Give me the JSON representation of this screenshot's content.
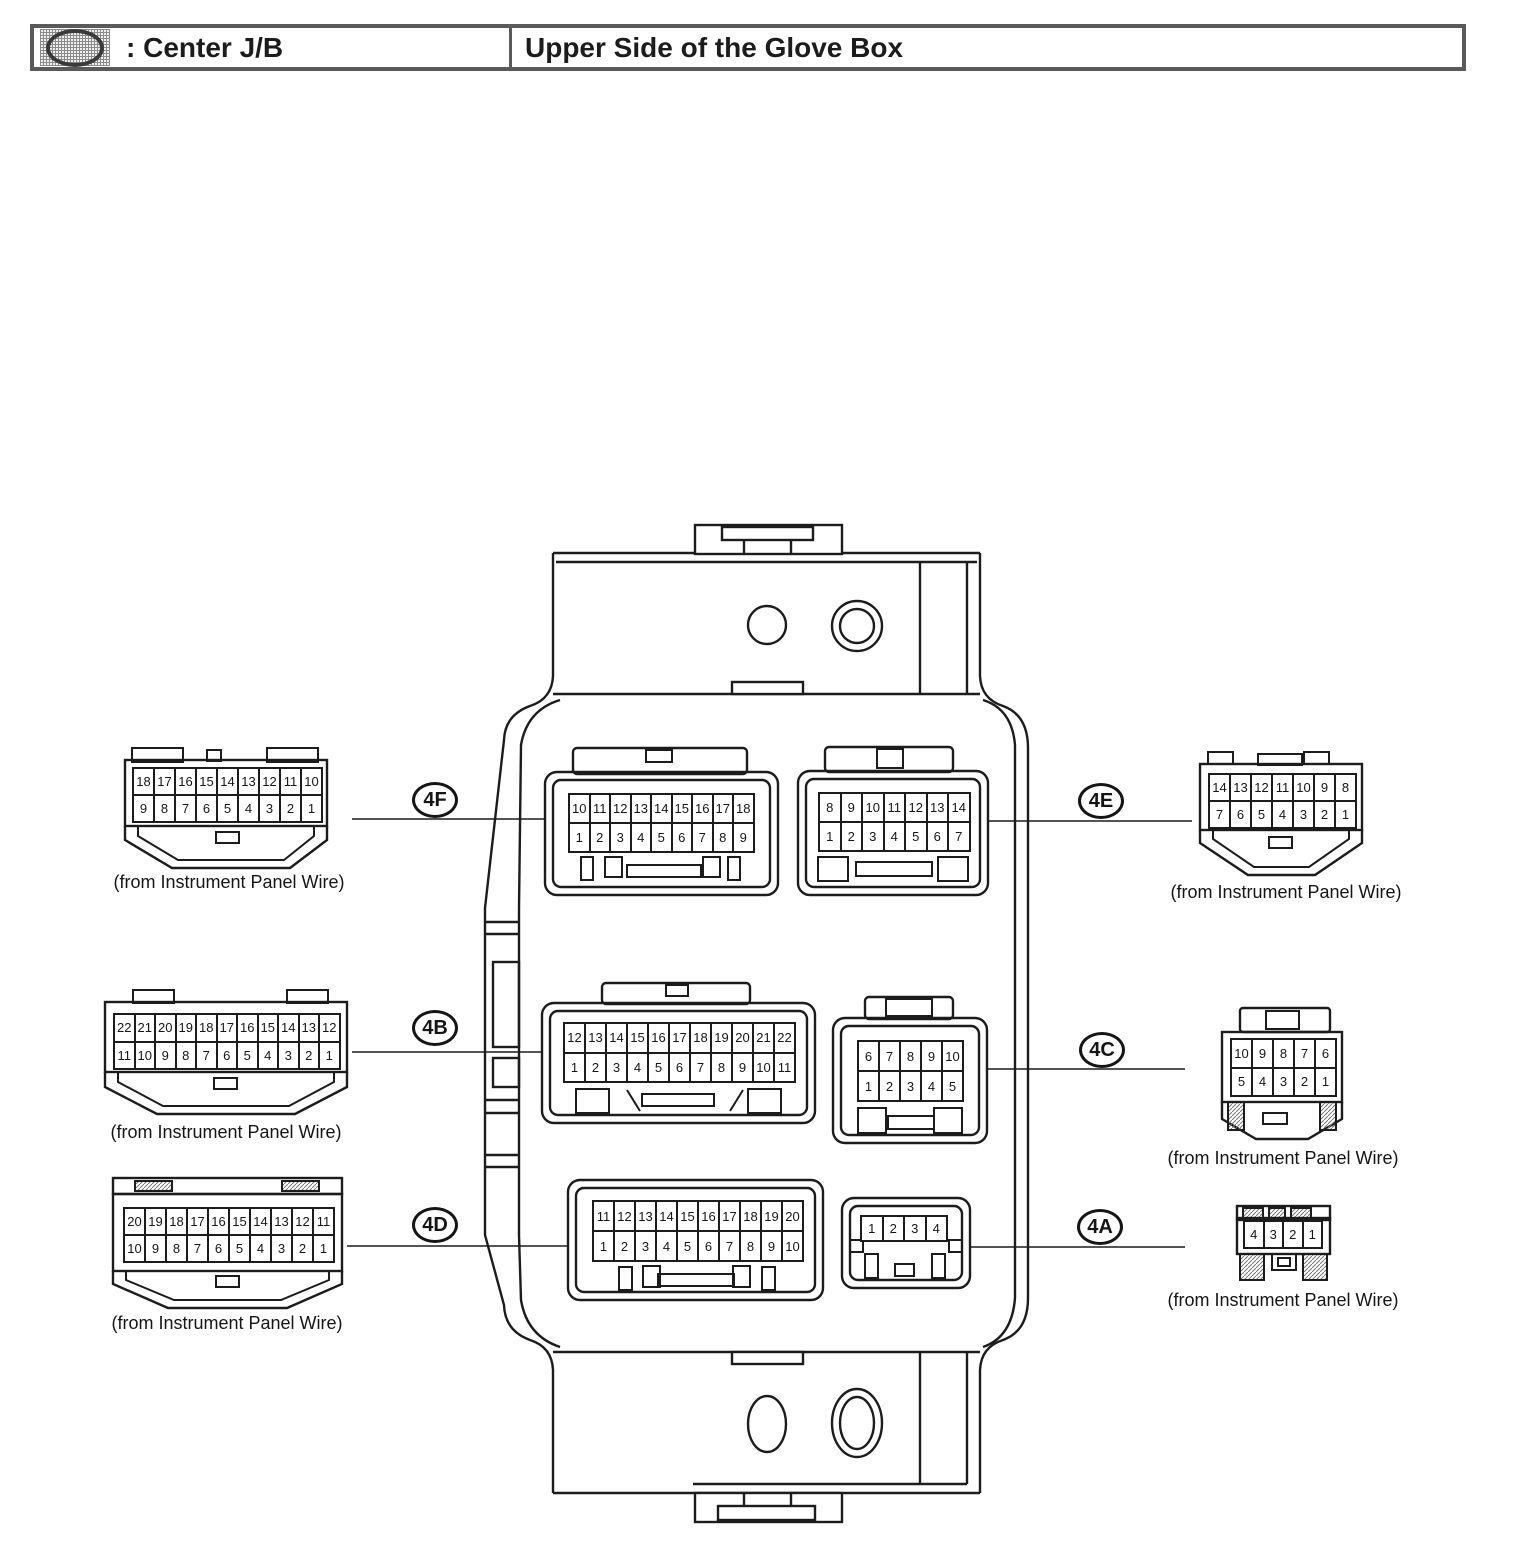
{
  "header": {
    "icon": "junction-block-oval-icon",
    "legend_label": ": Center J/B",
    "location_title": "Upper Side of the Glove Box"
  },
  "diagram": {
    "subject": "Center Junction Block connector view",
    "line_color": "#1c1c1c",
    "background_color": "#ffffff"
  },
  "connectors": {
    "4F": {
      "id": "4F",
      "rows": [
        [
          10,
          11,
          12,
          13,
          14,
          15,
          16,
          17,
          18
        ],
        [
          1,
          2,
          3,
          4,
          5,
          6,
          7,
          8,
          9
        ]
      ]
    },
    "4E": {
      "id": "4E",
      "rows": [
        [
          8,
          9,
          10,
          11,
          12,
          13,
          14
        ],
        [
          1,
          2,
          3,
          4,
          5,
          6,
          7
        ]
      ]
    },
    "4B": {
      "id": "4B",
      "rows": [
        [
          12,
          13,
          14,
          15,
          16,
          17,
          18,
          19,
          20,
          21,
          22
        ],
        [
          1,
          2,
          3,
          4,
          5,
          6,
          7,
          8,
          9,
          10,
          11
        ]
      ]
    },
    "4C": {
      "id": "4C",
      "rows": [
        [
          6,
          7,
          8,
          9,
          10
        ],
        [
          1,
          2,
          3,
          4,
          5
        ]
      ]
    },
    "4D": {
      "id": "4D",
      "rows": [
        [
          11,
          12,
          13,
          14,
          15,
          16,
          17,
          18,
          19,
          20
        ],
        [
          1,
          2,
          3,
          4,
          5,
          6,
          7,
          8,
          9,
          10
        ]
      ]
    },
    "4A": {
      "id": "4A",
      "rows": [
        [
          1,
          2,
          3,
          4
        ]
      ]
    }
  },
  "harness_connectors": {
    "left_top": {
      "rows": [
        [
          18,
          17,
          16,
          15,
          14,
          13,
          12,
          11,
          10
        ],
        [
          9,
          8,
          7,
          6,
          5,
          4,
          3,
          2,
          1
        ]
      ],
      "caption": "(from Instrument Panel Wire)"
    },
    "left_middle": {
      "rows": [
        [
          22,
          21,
          20,
          19,
          18,
          17,
          16,
          15,
          14,
          13,
          12
        ],
        [
          11,
          10,
          9,
          8,
          7,
          6,
          5,
          4,
          3,
          2,
          1
        ]
      ],
      "caption": "(from Instrument Panel Wire)"
    },
    "left_bottom": {
      "rows": [
        [
          20,
          19,
          18,
          17,
          16,
          15,
          14,
          13,
          12,
          11
        ],
        [
          10,
          9,
          8,
          7,
          6,
          5,
          4,
          3,
          2,
          1
        ]
      ],
      "caption": "(from Instrument Panel Wire)"
    },
    "right_top": {
      "rows": [
        [
          14,
          13,
          12,
          11,
          10,
          9,
          8
        ],
        [
          7,
          6,
          5,
          4,
          3,
          2,
          1
        ]
      ],
      "caption": "(from Instrument Panel Wire)"
    },
    "right_middle": {
      "rows": [
        [
          10,
          9,
          8,
          7,
          6
        ],
        [
          5,
          4,
          3,
          2,
          1
        ]
      ],
      "caption": "(from Instrument Panel Wire)"
    },
    "right_bottom": {
      "rows": [
        [
          4,
          3,
          2,
          1
        ]
      ],
      "caption": "(from Instrument Panel Wire)"
    }
  }
}
